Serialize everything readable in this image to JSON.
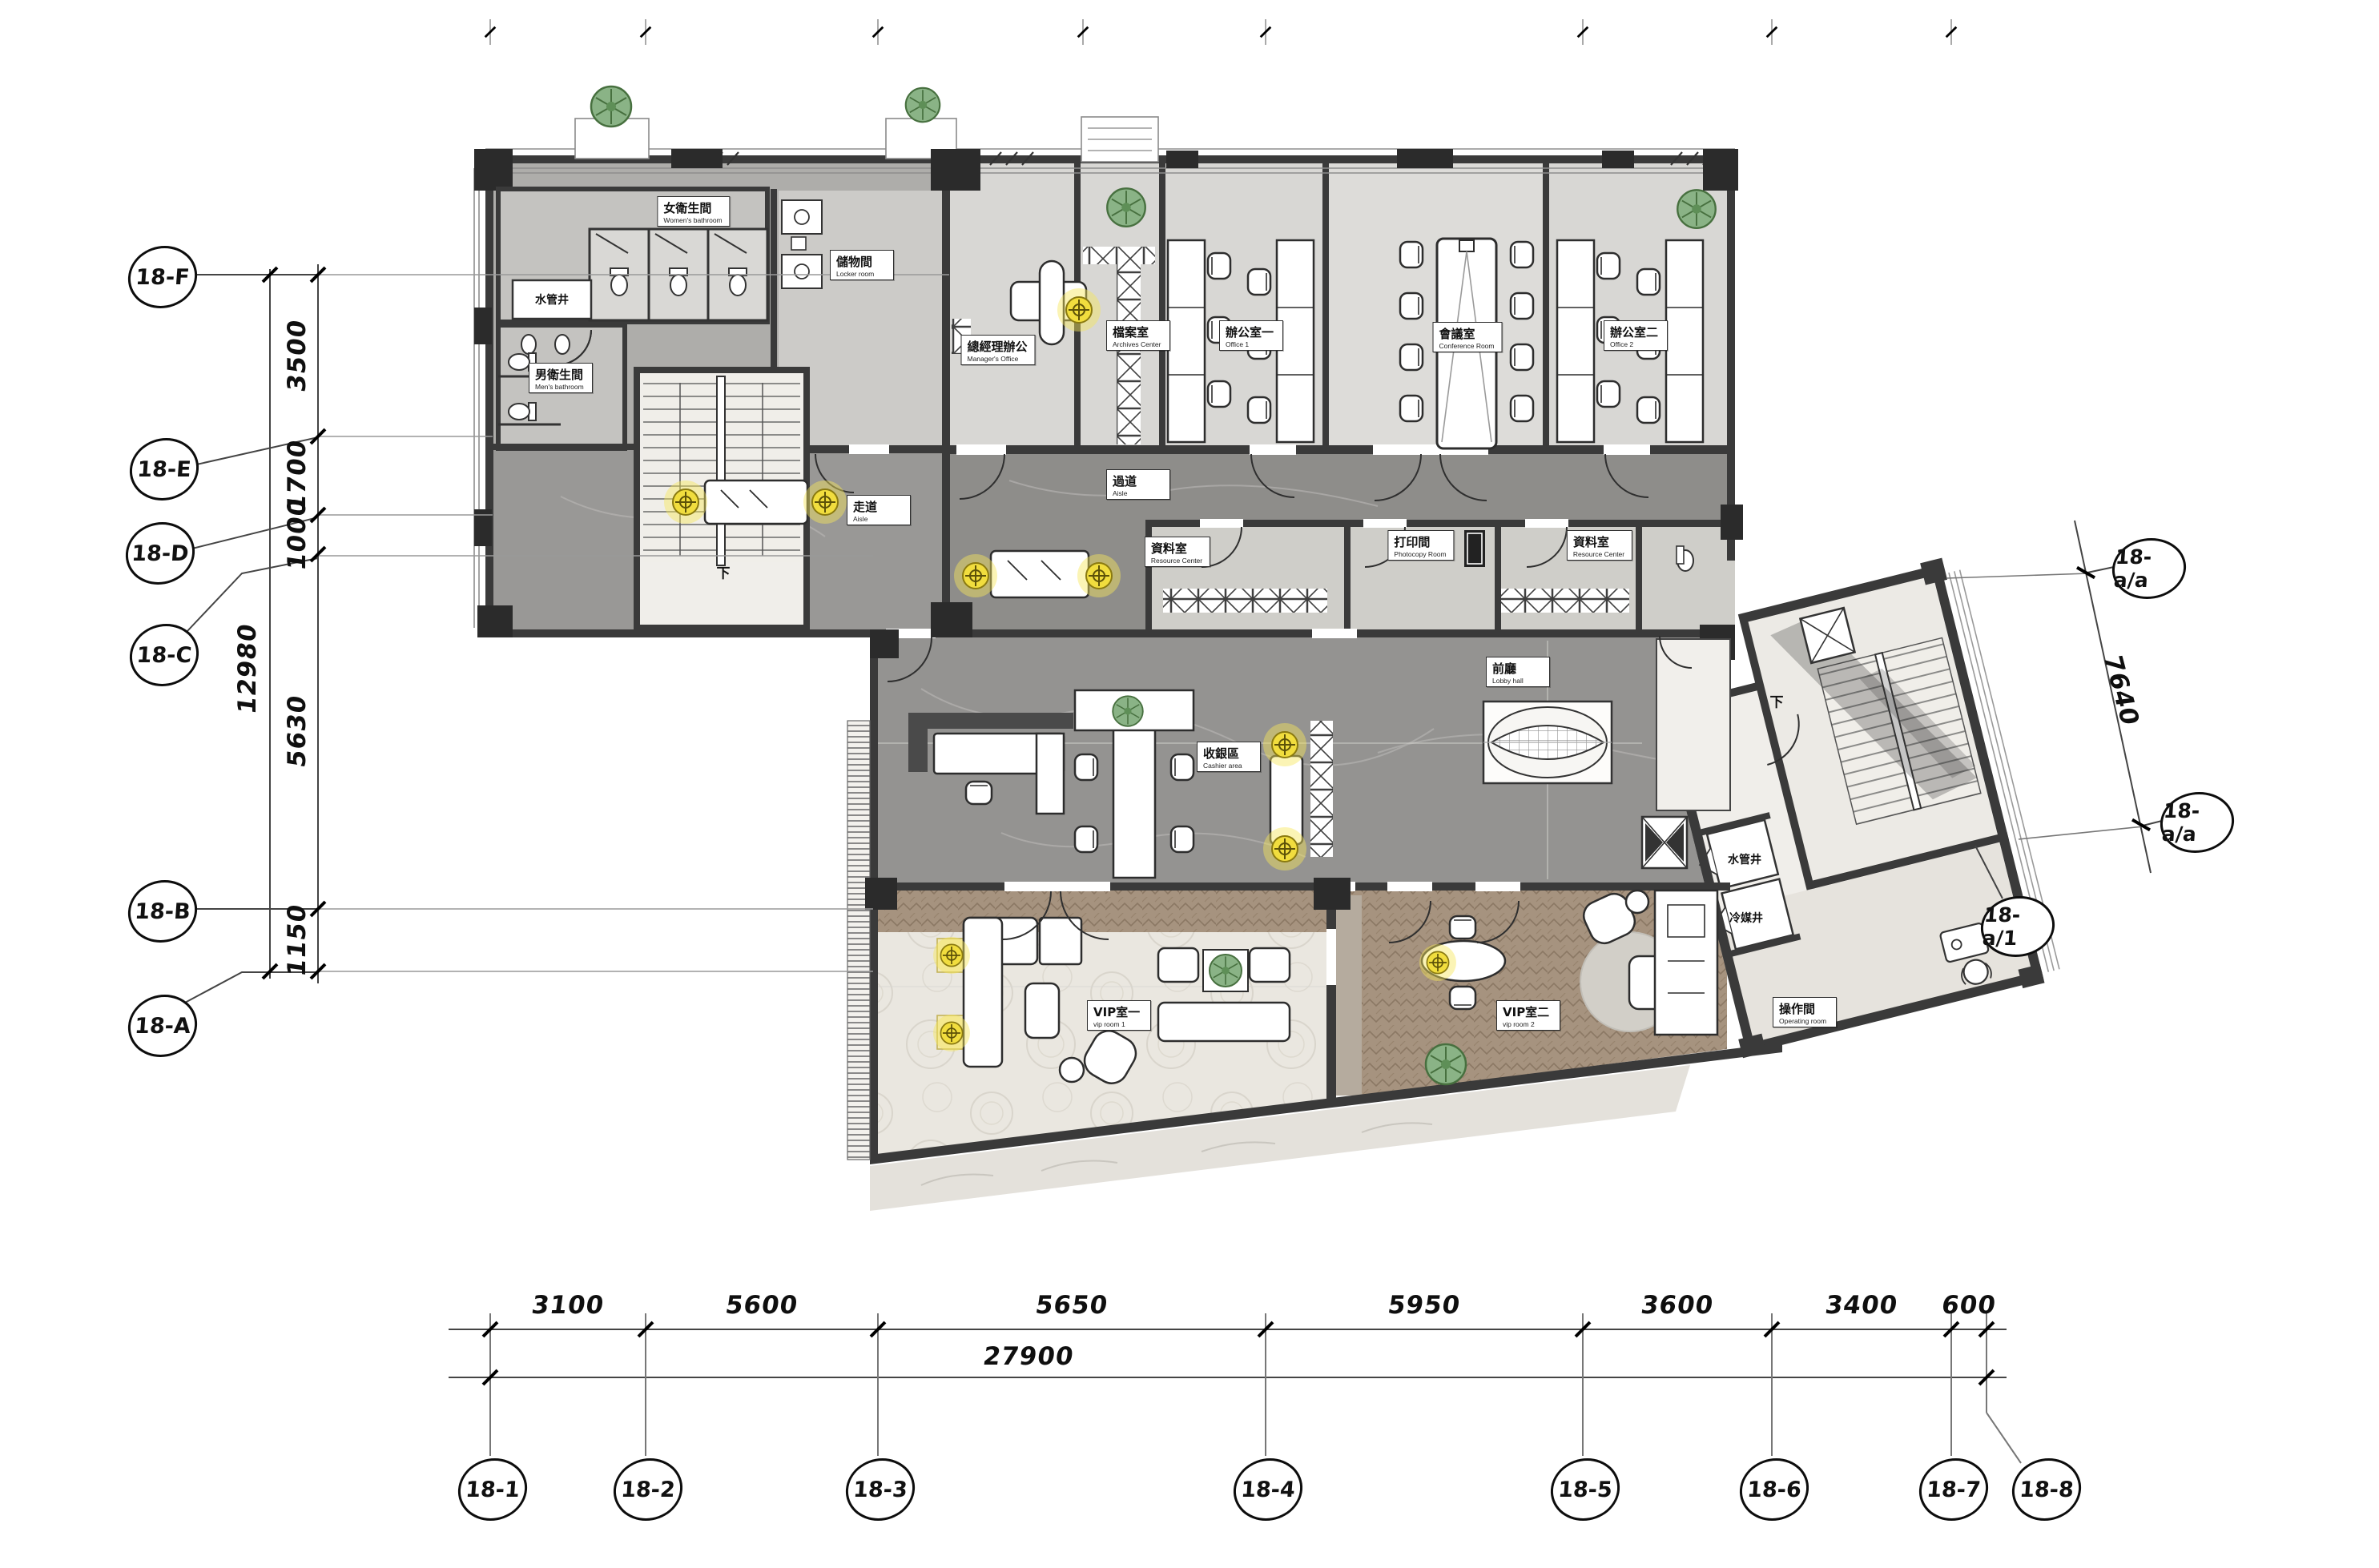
{
  "grid": {
    "bottom": [
      "18-1",
      "18-2",
      "18-3",
      "18-4",
      "18-5",
      "18-6",
      "18-7",
      "18-8"
    ],
    "left": [
      "18-F",
      "18-E",
      "18-D",
      "18-C",
      "18-B",
      "18-A"
    ],
    "right_top": "18-a/a",
    "right_bottom": "18-a/a",
    "right_corner": "18-a/1"
  },
  "dims": {
    "bottom": [
      "3100",
      "5600",
      "5650",
      "5950",
      "3600",
      "3400",
      "600"
    ],
    "bottom_total": "27900",
    "left": [
      "3500",
      "1700",
      "1000",
      "5630",
      "1150"
    ],
    "left_total": "12980",
    "right": "7640"
  },
  "rooms": [
    {
      "zh": "水管井",
      "en": ""
    },
    {
      "zh": "女衛生間",
      "en": "Women's bathroom"
    },
    {
      "zh": "儲物間",
      "en": "Locker room"
    },
    {
      "zh": "男衛生間",
      "en": "Men's bathroom"
    },
    {
      "zh": "總經理辦公",
      "en": "Manager's Office"
    },
    {
      "zh": "檔案室",
      "en": "Archives Center"
    },
    {
      "zh": "辦公室一",
      "en": "Office 1"
    },
    {
      "zh": "會議室",
      "en": "Conference Room"
    },
    {
      "zh": "辦公室二",
      "en": "Office 2"
    },
    {
      "zh": "走道",
      "en": "Aisle"
    },
    {
      "zh": "過道",
      "en": "Aisle"
    },
    {
      "zh": "資料室",
      "en": "Resource Center"
    },
    {
      "zh": "打印間",
      "en": "Photocopy Room"
    },
    {
      "zh": "資料室",
      "en": "Resource Center"
    },
    {
      "zh": "前廳",
      "en": "Lobby hall"
    },
    {
      "zh": "收銀區",
      "en": "Cashier area"
    },
    {
      "zh": "VIP室一",
      "en": "vip room 1"
    },
    {
      "zh": "VIP室二",
      "en": "vip room 2"
    },
    {
      "zh": "操作間",
      "en": "Operating room"
    },
    {
      "zh": "水管井",
      "en": ""
    },
    {
      "zh": "冷媒井",
      "en": ""
    }
  ],
  "stair": {
    "down": "下"
  }
}
